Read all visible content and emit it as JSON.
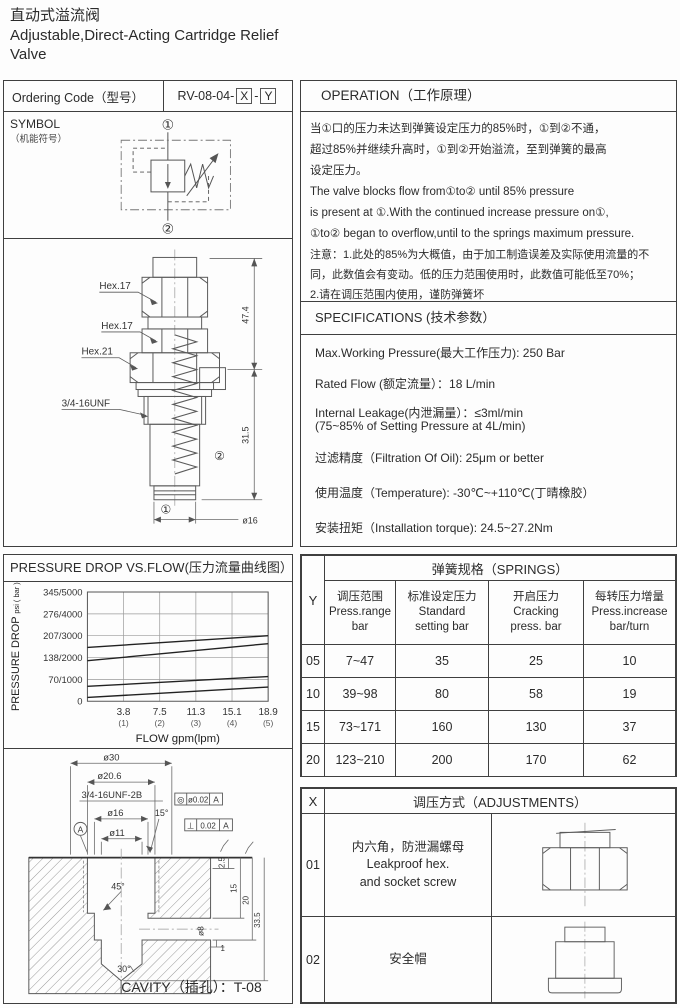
{
  "header": {
    "title_zh": "直动式溢流阀",
    "title_en1": "Adjustable,Direct-Acting Cartridge Relief",
    "title_en2": "Valve"
  },
  "ordering": {
    "label": "Ordering Code（型号）",
    "prefix": "RV-08-04-",
    "x": "X",
    "sep": "-",
    "y": "Y"
  },
  "operation": {
    "title": "OPERATION（工作原理）",
    "lines": [
      "当①口的压力未达到弹簧设定压力的85%时，①到②不通，",
      "超过85%并继续升高时，①到②开始溢流，至到弹簧的最高",
      "设定压力。",
      "The valve blocks flow from①to② until 85% pressure",
      "is present at ①.With the continued increase pressure on①,",
      "①to② began to overflow,until to the springs maximum pressure.",
      "注意：1.此处的85%为大概值，由于加工制造误差及实际使用流量的不",
      "同，此数值会有变动。低的压力范围使用时，此数值可能低至70%；",
      "2.请在调压范围内使用，谨防弹簧坏"
    ]
  },
  "symbol": {
    "label1": "SYMBOL",
    "label2": "（机能符号）",
    "port1": "①",
    "port2": "②"
  },
  "valve_drawing": {
    "hex17_a": "Hex.17",
    "hex17_b": "Hex.17",
    "hex21": "Hex.21",
    "thread": "3/4-16UNF",
    "dim_upper": "47.4",
    "dim_lower": "31.5",
    "dia_tip": "ø16",
    "port1": "①",
    "port2": "②"
  },
  "specifications": {
    "title": "SPECIFICATIONS (技术参数）",
    "items": [
      {
        "line1": "Max.Working Pressure(最大工作压力): 250 Bar"
      },
      {
        "line1": "Rated Flow (额定流量）：18 L/min"
      },
      {
        "line1": "Internal Leakage(内泄漏量）：≤3ml/min",
        "line2": "(75~85% of Setting Pressure at 4L/min)"
      },
      {
        "line1": "过滤精度（Filtration Of Oil):   25μm or better"
      },
      {
        "line1": "使用温度（Temperature):   -30℃~+110℃(丁晴橡胶）"
      },
      {
        "line1": "安装扭矩（Installation torque):   24.5~27.2Nm"
      }
    ]
  },
  "chart_data": {
    "type": "line",
    "title": "PRESSURE DROP VS.FLOW(压力流量曲线图）",
    "xlabel": "FLOW gpm(lpm)",
    "ylabel": "PRESSURE DROP",
    "ylabel_unit": "psi ( bar )",
    "x_range": [
      0,
      18.9
    ],
    "y_range": [
      0,
      345
    ],
    "x_ticks": [
      {
        "main": "3.8",
        "sub": "(1)"
      },
      {
        "main": "7.5",
        "sub": "(2)"
      },
      {
        "main": "11.3",
        "sub": "(3)"
      },
      {
        "main": "15.1",
        "sub": "(4)"
      },
      {
        "main": "18.9",
        "sub": "(5)"
      }
    ],
    "y_ticks": [
      "0",
      "70/1000",
      "138/2000",
      "207/3000",
      "276/4000",
      "345/5000"
    ],
    "grid": true,
    "legend": "none",
    "series": [
      {
        "name": "spring 20",
        "x": [
          0,
          18.9
        ],
        "y": [
          170,
          207
        ]
      },
      {
        "name": "spring 15",
        "x": [
          0,
          18.9
        ],
        "y": [
          128,
          182
        ]
      },
      {
        "name": "spring 10",
        "x": [
          0,
          18.9
        ],
        "y": [
          47,
          78
        ]
      },
      {
        "name": "spring 05",
        "x": [
          0,
          18.9
        ],
        "y": [
          12,
          45
        ]
      }
    ]
  },
  "springs_table": {
    "corner": "Y",
    "title": "弹簧规格（SPRINGS）",
    "columns": [
      {
        "l1": "调压范围",
        "l2": "Press.range",
        "l3": "bar"
      },
      {
        "l1": "标准设定压力",
        "l2": "Standard",
        "l3": "setting bar"
      },
      {
        "l1": "开启压力",
        "l2": "Cracking",
        "l3": "press. bar"
      },
      {
        "l1": "每转压力增量",
        "l2": "Press.increase",
        "l3": "bar/turn"
      }
    ],
    "rows": [
      {
        "y": "05",
        "range": "7~47",
        "standard": "35",
        "cracking": "25",
        "increase": "10"
      },
      {
        "y": "10",
        "range": "39~98",
        "standard": "80",
        "cracking": "58",
        "increase": "19"
      },
      {
        "y": "15",
        "range": "73~171",
        "standard": "160",
        "cracking": "130",
        "increase": "37"
      },
      {
        "y": "20",
        "range": "123~210",
        "standard": "200",
        "cracking": "170",
        "increase": "62"
      }
    ]
  },
  "adjustments_table": {
    "corner": "X",
    "title": "调压方式（ADJUSTMENTS）",
    "rows": [
      {
        "x": "01",
        "desc1": "内六角，防泄漏螺母",
        "desc2": "Leakproof hex.",
        "desc3": "and socket screw"
      },
      {
        "x": "02",
        "desc1": "安全帽"
      }
    ]
  },
  "cavity": {
    "caption": "CAVITY（插孔）：T-08",
    "labels": {
      "d30": "ø30",
      "d206": "ø20.6",
      "thread": "3/4-16UNF-2B",
      "d16": "ø16",
      "d11": "ø11",
      "a15": "15°",
      "a45": "45°",
      "a30": "30°",
      "datum": "A",
      "tol1_sym": "◎",
      "tol1_val": "ø0.02",
      "tol1_ref": "A",
      "tol2_sym": "⊥",
      "tol2_val": "0.02",
      "tol2_ref": "A",
      "dim_2_5": "2.5",
      "dim_15": "15",
      "dim_20": "20",
      "dim_33_5": "33.5",
      "d8": "ø8",
      "dim_1": "1"
    }
  }
}
